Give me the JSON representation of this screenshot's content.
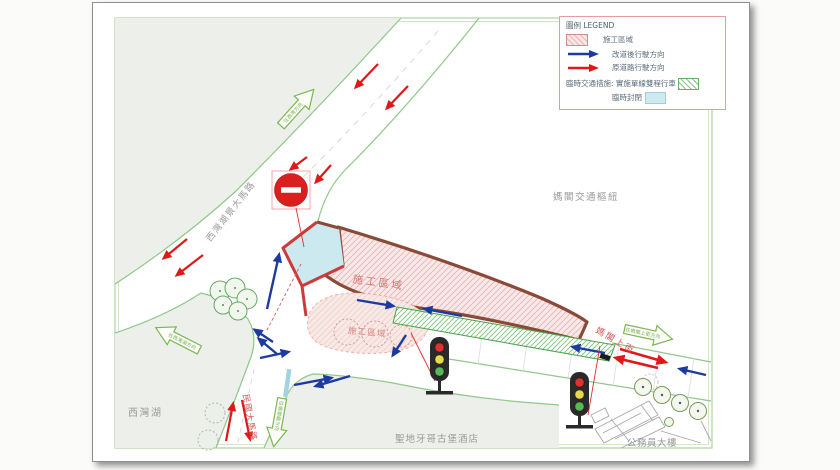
{
  "legend": {
    "title": "圖例 LEGEND",
    "items": [
      {
        "label": "施工區域",
        "swatch": "construction-hatch"
      },
      {
        "label": "改道後行駛方向",
        "swatch": "blue-arrow"
      },
      {
        "label": "原道路行駛方向",
        "swatch": "red-arrow"
      }
    ],
    "note_label": "臨時交通措施:",
    "note_single_lane": "實施單線雙程行車",
    "note_closed": "臨時封閉"
  },
  "labels": {
    "hub": "媽閣交通樞紐",
    "lake": "西灣湖",
    "hotel": "聖地牙哥古堡酒店",
    "building": "公務員大樓",
    "road_main": "西灣湖景大馬路",
    "road_minkuo": "民國大馬路",
    "road_magok": "媽閣上街",
    "construction_1": "施工區域",
    "construction_2": "施工區域"
  },
  "direction_arrows": {
    "a": "往西灣方向",
    "b": "往西灣湖方向",
    "c": "往媽閣廟方向",
    "d": "往媽閣上街方向"
  },
  "icons": {
    "no_entry_sign": "no-entry-sign",
    "traffic_light": "traffic-light"
  },
  "colors": {
    "construction_border": "#8a4a38",
    "construction_fill": "#f8e8e8",
    "diverted_direction": "#1c3aa0",
    "original_direction": "#e21717",
    "temporary_closed": "#cde9f0",
    "single_lane_two_way": "#4aa04a",
    "road_edge_green": "#90c78a",
    "label_gray": "#9a9a9a",
    "label_red": "#d05858"
  }
}
